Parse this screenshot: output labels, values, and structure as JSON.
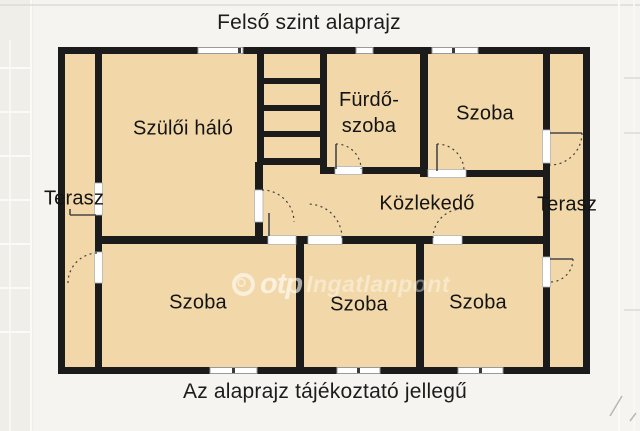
{
  "title": "Felső szint alaprajz",
  "footnote": "Az alaprajz tájékoztató jellegű",
  "watermark": {
    "brand": "otp",
    "suffix": "Ingatlanpont"
  },
  "rooms": {
    "parents_bedroom": "Szülői háló",
    "bathroom_line1": "Fürdő-",
    "bathroom_line2": "szoba",
    "room_top_right": "Szoba",
    "hallway": "Közlekedő",
    "terrace_left": "Terasz",
    "terrace_right": "Terasz",
    "room_bottom_left": "Szoba",
    "room_bottom_middle": "Szoba",
    "room_bottom_right": "Szoba"
  },
  "colors": {
    "background": "#f6f4f0",
    "room_fill": "#f2d8a8",
    "wall": "#1b1b1b",
    "watermark": "#ffffff"
  }
}
